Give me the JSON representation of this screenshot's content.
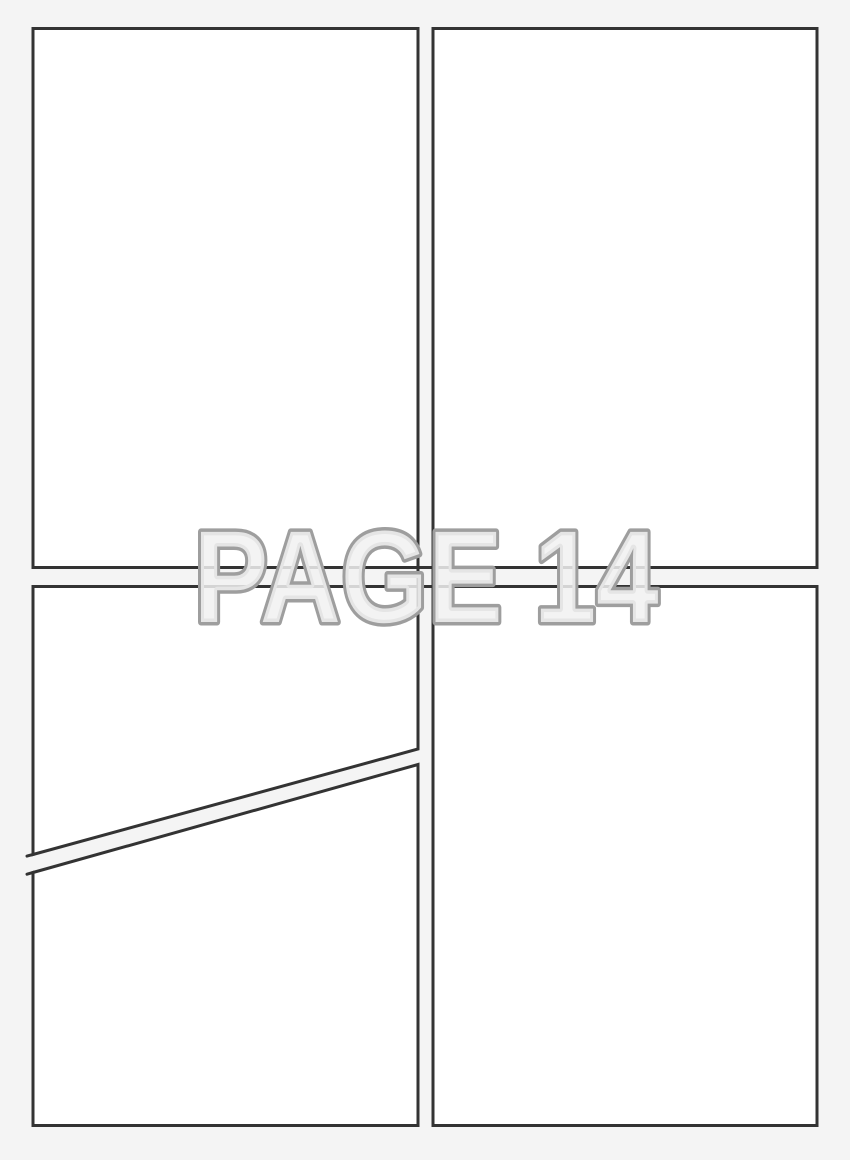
{
  "watermark": {
    "label": "PAGE 14"
  },
  "colors": {
    "background": "#f4f4f4",
    "panel-fill": "#ffffff",
    "panel-border": "#333333",
    "watermark-fill": "#f1f1f1",
    "watermark-outline": "#9e9e9e"
  }
}
